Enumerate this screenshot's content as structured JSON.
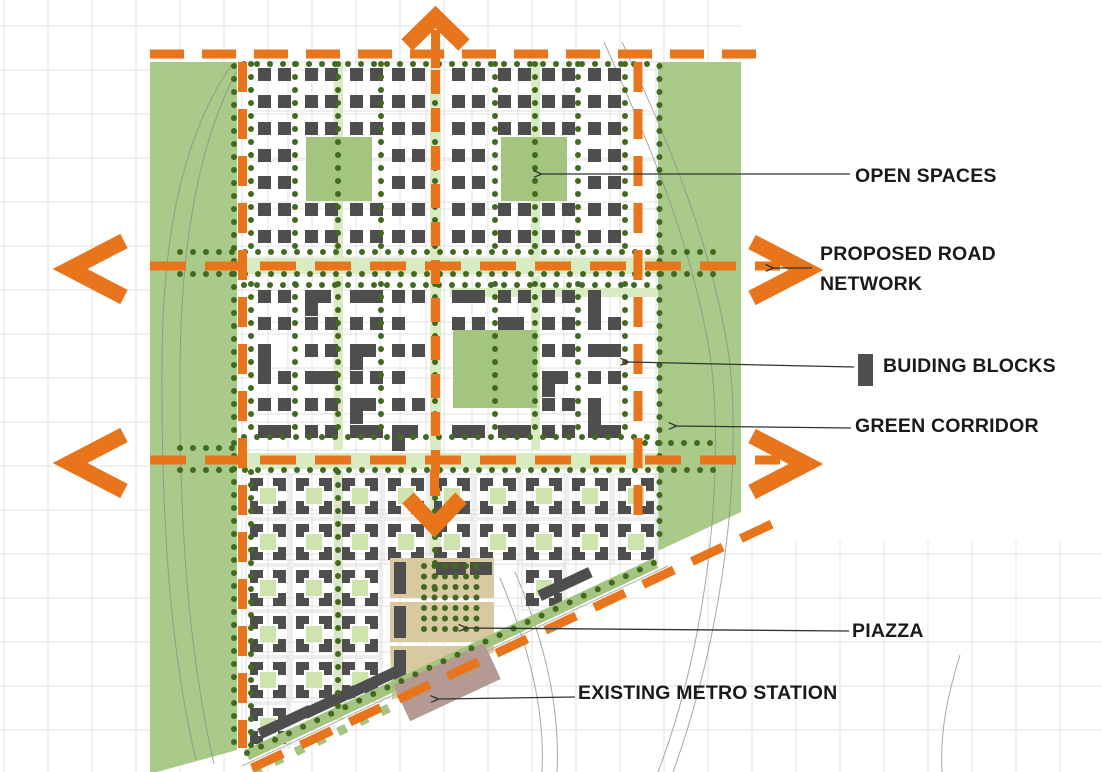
{
  "legend": {
    "open_spaces": "OPEN SPACES",
    "proposed_road_network": "PROPOSED ROAD NETWORK",
    "building_blocks": "BUIDING BLOCKS",
    "green_corridor": "GREEN CORRIDOR",
    "piazza": "PIAZZA",
    "existing_metro_station": "EXISTING METRO STATION"
  },
  "colors": {
    "road_orange": "#E8751C",
    "green_corridor": "#A3C57F",
    "light_green": "#D9EBC0",
    "courtyard_green": "#CDE5AC",
    "tree_dot": "#41691F",
    "building_gray": "#4E4E4E",
    "piazza_tan": "#D9C9A1",
    "metro_mauve": "#B49A92",
    "grid_line": "#C9C9CF",
    "street_line": "#CFCFCF",
    "curve_line": "#8A8A8A",
    "leader_line": "#333333",
    "label_text": "#1A1A1A",
    "background": "#FFFFFF"
  }
}
